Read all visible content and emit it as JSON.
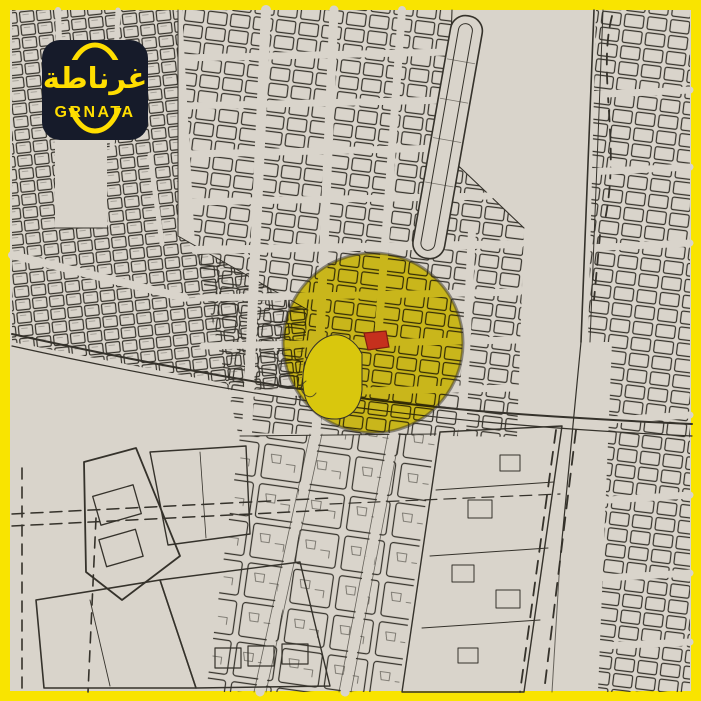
{
  "logo": {
    "arabic": "غرناطة",
    "latin": "GRNATA"
  },
  "colors": {
    "frame": "#F9E400",
    "map_background": "#D9D4CB",
    "map_line": "#35322B",
    "highlight_circle": "#EAD600",
    "highlight_blob": "#D9C70D",
    "marker_red": "#C5301D",
    "marker_red_border": "#801D10",
    "logo_background": "#161B2A",
    "logo_accent": "#FFDE00"
  },
  "map": {
    "highlight": {
      "cx": 373,
      "cy": 343,
      "r": 90
    }
  }
}
